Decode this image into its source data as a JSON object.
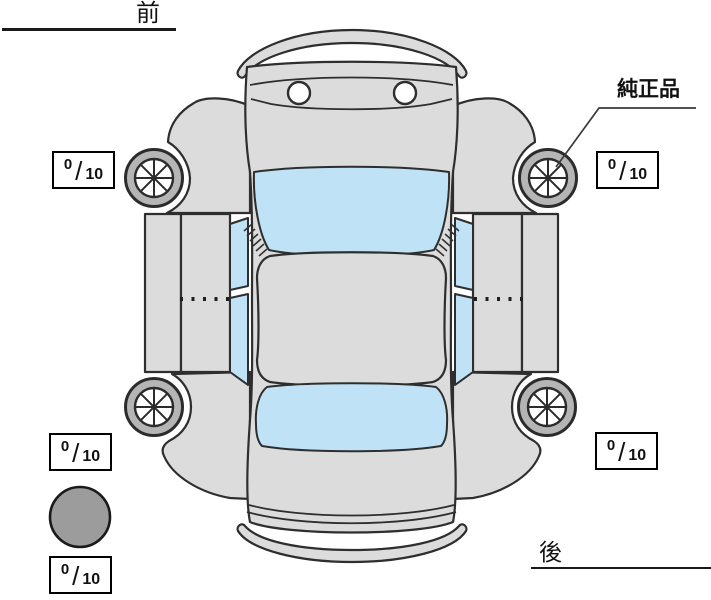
{
  "labels": {
    "front": "前",
    "rear": "後",
    "genuine_part": "純正品"
  },
  "tread_scores": {
    "front_left": {
      "value": "0",
      "slash": "/",
      "max": "10"
    },
    "front_right": {
      "value": "0",
      "slash": "/",
      "max": "10"
    },
    "rear_left": {
      "value": "0",
      "slash": "/",
      "max": "10"
    },
    "rear_right": {
      "value": "0",
      "slash": "/",
      "max": "10"
    },
    "spare": {
      "value": "0",
      "slash": "/",
      "max": "10"
    }
  },
  "diagram": {
    "type": "car-top-view-inspection",
    "front_label_position": "top-left",
    "rear_label_position": "bottom-right",
    "genuine_part_pointer_target": "front-right-wheel",
    "wheels": [
      "front-left",
      "front-right",
      "rear-left",
      "rear-right",
      "spare"
    ]
  },
  "colors": {
    "background": "#ffffff",
    "body": "#dcdcdc",
    "glass": "#bfe2f6",
    "tire_ring": "#b5b5b5",
    "spare_tire": "#9c9c9c",
    "outline": "#2e2e2e"
  }
}
